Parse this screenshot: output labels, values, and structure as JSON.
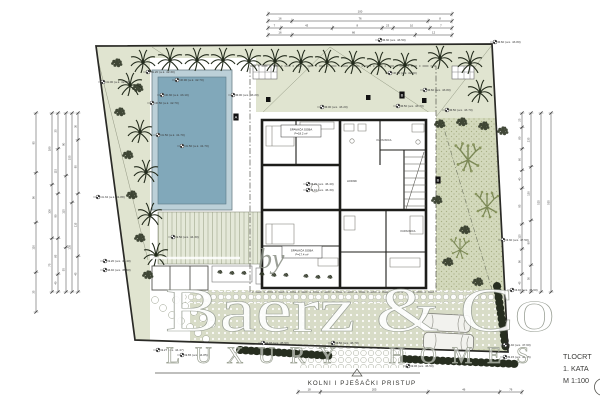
{
  "title_block": {
    "drawing": "TLOCRT",
    "floor": "1. KATA",
    "scale": "M 1:100"
  },
  "labels": {
    "access_road": "KOLNI I PJEŠAČKI PRISTUP"
  },
  "watermark": {
    "prefix": "by",
    "brand": "Baerz & Co",
    "tagline": "LUXURY HOMES"
  },
  "colors": {
    "lawn": "#e0e4d0",
    "garden": "#d3d9bc",
    "paving": "#d8dcc7",
    "pool_water": "#81a8ba",
    "pool_edge": "#bcd0d8",
    "wall": "#1d1d1a",
    "hedge": "#272e20",
    "dim": "#3c3c3c"
  },
  "plan": {
    "levels": [
      {
        "x": 103,
        "y": 82,
        "t": "-1.00 (a.k. 42.20)"
      },
      {
        "x": 148,
        "y": 72,
        "t": "-1.20 (a.k. 42.30)"
      },
      {
        "x": 177,
        "y": 80,
        "t": "-0.90 (a.k. 42.70)"
      },
      {
        "x": 162,
        "y": 95,
        "t": "-0.30 (a.k. 43.10)"
      },
      {
        "x": 152,
        "y": 103,
        "t": "-0.50 (a.k. 42.70)"
      },
      {
        "x": 158,
        "y": 135,
        "t": "-1.50 (a.k. 41.70)"
      },
      {
        "x": 182,
        "y": 146,
        "t": "-1.50 (a.k. 41.70)"
      },
      {
        "x": 233,
        "y": 95,
        "t": "0.00 (a.k. 43.20)"
      },
      {
        "x": 322,
        "y": 107,
        "t": "0.00 (a.k. 43.20)"
      },
      {
        "x": 398,
        "y": 106,
        "t": "0.50 (a.k. 43.70)"
      },
      {
        "x": 447,
        "y": 110,
        "t": "0.50 (a.k. 43.70)"
      },
      {
        "x": 390,
        "y": 73,
        "t": "-0.80 (a.k. 42.40)"
      },
      {
        "x": 425,
        "y": 90,
        "t": "0.60 (a.k. 43.80)"
      },
      {
        "x": 495,
        "y": 42,
        "t": "0.60 (a.k. 43.80)"
      },
      {
        "x": 380,
        "y": 40,
        "t": "0.30 (a.k. 43.50)"
      },
      {
        "x": 98,
        "y": 197,
        "t": "-1.32 (a.k. 41.88)"
      },
      {
        "x": 105,
        "y": 261,
        "t": "1.20 (a.k. 46.40)"
      },
      {
        "x": 105,
        "y": 270,
        "t": "2.40 (a.k. 45.60)"
      },
      {
        "x": 173,
        "y": 237,
        "t": "1.50 (a.k. 44.30)"
      },
      {
        "x": 308,
        "y": 184,
        "t": "3.20 (a.k. 46.40)"
      },
      {
        "x": 308,
        "y": 190,
        "t": "3.10 (a.k. 46.30)"
      },
      {
        "x": 158,
        "y": 350,
        "t": "1.27 (a.k. 44.47)"
      },
      {
        "x": 182,
        "y": 355,
        "t": "1.65 (a.k. 44.85)"
      },
      {
        "x": 263,
        "y": 343,
        "t": "1.76 (a.k. 45.90)"
      },
      {
        "x": 333,
        "y": 343,
        "t": "3.50 (a.k. 46.70)"
      },
      {
        "x": 408,
        "y": 366,
        "t": "1.06 (a.k. 46.50)"
      },
      {
        "x": 505,
        "y": 357,
        "t": "5.15 (a.k. 46.35)"
      },
      {
        "x": 505,
        "y": 345,
        "t": "4.40 (a.k. 47.60)"
      },
      {
        "x": 503,
        "y": 240,
        "t": "4.30 (a.k. 47.50)"
      },
      {
        "x": 512,
        "y": 290,
        "t": "4.40 (a.k. 47.60)"
      }
    ],
    "rooms": [
      {
        "x": 301,
        "y": 131,
        "w": 40,
        "h": 12,
        "l1": "SPAVAĆA SOBA",
        "l2": "P=18.2 m²"
      },
      {
        "x": 302,
        "y": 252,
        "w": 40,
        "h": 12,
        "l1": "SPAVAĆA SOBA",
        "l2": "P=17.4 m²"
      }
    ],
    "small_labels": [
      {
        "x": 384,
        "y": 141,
        "t": "KUPAONICA"
      },
      {
        "x": 352,
        "y": 182,
        "t": "HODNIK"
      },
      {
        "x": 408,
        "y": 232,
        "t": "KUPAONICA"
      }
    ],
    "section_markers": [
      {
        "x": 236,
        "y": 117,
        "t": "A"
      },
      {
        "x": 402,
        "y": 95,
        "t": "B"
      },
      {
        "x": 438,
        "y": 180,
        "t": "B"
      }
    ],
    "trees": {
      "palms": [
        [
          143,
          62
        ],
        [
          170,
          60
        ],
        [
          197,
          60
        ],
        [
          223,
          60
        ],
        [
          249,
          61
        ],
        [
          275,
          61
        ],
        [
          301,
          62
        ],
        [
          327,
          62
        ],
        [
          353,
          63
        ],
        [
          379,
          64
        ],
        [
          405,
          65
        ],
        [
          440,
          58
        ],
        [
          470,
          63
        ],
        [
          480,
          92
        ],
        [
          130,
          85
        ],
        [
          140,
          132
        ],
        [
          146,
          172
        ],
        [
          150,
          215
        ],
        [
          156,
          255
        ]
      ],
      "bushes": [
        [
          117,
          63
        ],
        [
          138,
          88
        ],
        [
          120,
          112
        ],
        [
          128,
          155
        ],
        [
          132,
          195
        ],
        [
          140,
          238
        ],
        [
          148,
          275
        ],
        [
          440,
          124
        ],
        [
          462,
          122
        ],
        [
          484,
          126
        ],
        [
          503,
          131
        ],
        [
          437,
          200
        ],
        [
          465,
          230
        ],
        [
          478,
          282
        ],
        [
          448,
          262
        ],
        [
          220,
          272,
          0.45
        ],
        [
          232,
          273,
          0.45
        ],
        [
          244,
          273,
          0.45
        ],
        [
          262,
          274,
          0.45
        ],
        [
          274,
          275,
          0.45
        ],
        [
          286,
          275,
          0.45
        ],
        [
          306,
          276,
          0.45
        ],
        [
          318,
          277,
          0.45
        ],
        [
          330,
          277,
          0.45
        ]
      ],
      "olives": [
        [
          468,
          160,
          1.1
        ],
        [
          487,
          207,
          1.0
        ],
        [
          460,
          250,
          0.8
        ]
      ]
    },
    "dims": {
      "top": {
        "x1": 268,
        "x2": 452,
        "rows": [
          {
            "y": 14,
            "ticks": [
              0,
              1
            ],
            "labels": [
              "100"
            ]
          },
          {
            "y": 21,
            "ticks": [
              0,
              0.13,
              0.87,
              1
            ],
            "labels": [
              "16",
              "76",
              "8"
            ]
          },
          {
            "y": 28,
            "ticks": [
              0,
              0.07,
              0.35,
              0.62,
              0.68,
              0.88,
              1
            ],
            "labels": [
              "7",
              "43",
              "8",
              "23",
              "10",
              "7"
            ]
          },
          {
            "y": 35,
            "ticks": [
              0,
              0.13,
              0.8,
              1
            ],
            "labels": [
              "16",
              "66",
              "12"
            ]
          }
        ]
      },
      "left": {
        "y1": 113,
        "y2": 292,
        "cols": [
          {
            "x": 36,
            "y2": 312,
            "ticks": [
              0,
              0.3,
              0.55,
              0.8,
              1
            ],
            "labels": [
              "95",
              "90",
              "110",
              "35"
            ]
          },
          {
            "x": 52,
            "ticks": [
              0,
              0.4,
              0.7,
              1
            ],
            "labels": [
              "180",
              "100",
              "75"
            ]
          },
          {
            "x": 58,
            "ticks": [
              0,
              0.2,
              0.45,
              0.7,
              0.9,
              1
            ],
            "labels": [
              "35",
              "115",
              "90",
              "85",
              "40"
            ]
          },
          {
            "x": 66,
            "ticks": [
              0,
              0.35,
              0.75,
              1
            ],
            "labels": [
              "90",
              "115",
              "55"
            ]
          },
          {
            "x": 72,
            "ticks": [
              0,
              0.5,
              1
            ],
            "labels": [
              "155",
              "135"
            ]
          },
          {
            "x": 78,
            "ticks": [
              0,
              0.15,
              0.45,
              0.8,
              1
            ],
            "labels": [
              "30",
              "95",
              "115",
              "45"
            ]
          }
        ]
      },
      "right": {
        "y1": 113,
        "y2": 292,
        "cols": [
          {
            "x": 522,
            "ticks": [
              0,
              0.08,
              0.2,
              0.32,
              0.42,
              0.62,
              0.76,
              0.9,
              1
            ],
            "labels": [
              "25",
              "80",
              "60",
              "40",
              "95",
              "115",
              "90",
              "45"
            ]
          },
          {
            "x": 531,
            "ticks": [
              0,
              0.3,
              0.6,
              0.85,
              1
            ],
            "labels": [
              "235",
              "130",
              "90",
              "50"
            ]
          },
          {
            "x": 541,
            "ticks": [
              0,
              1
            ],
            "labels": [
              "525"
            ]
          },
          {
            "x": 551,
            "ticks": [
              0,
              1
            ],
            "labels": [
              "555"
            ]
          }
        ]
      },
      "bottom": {
        "y": 392,
        "x1": 298,
        "x2": 522,
        "ticks": [
          0,
          0.1,
          0.58,
          0.9,
          1
        ],
        "labels": [
          "18",
          "205",
          "46",
          "76"
        ]
      }
    }
  }
}
